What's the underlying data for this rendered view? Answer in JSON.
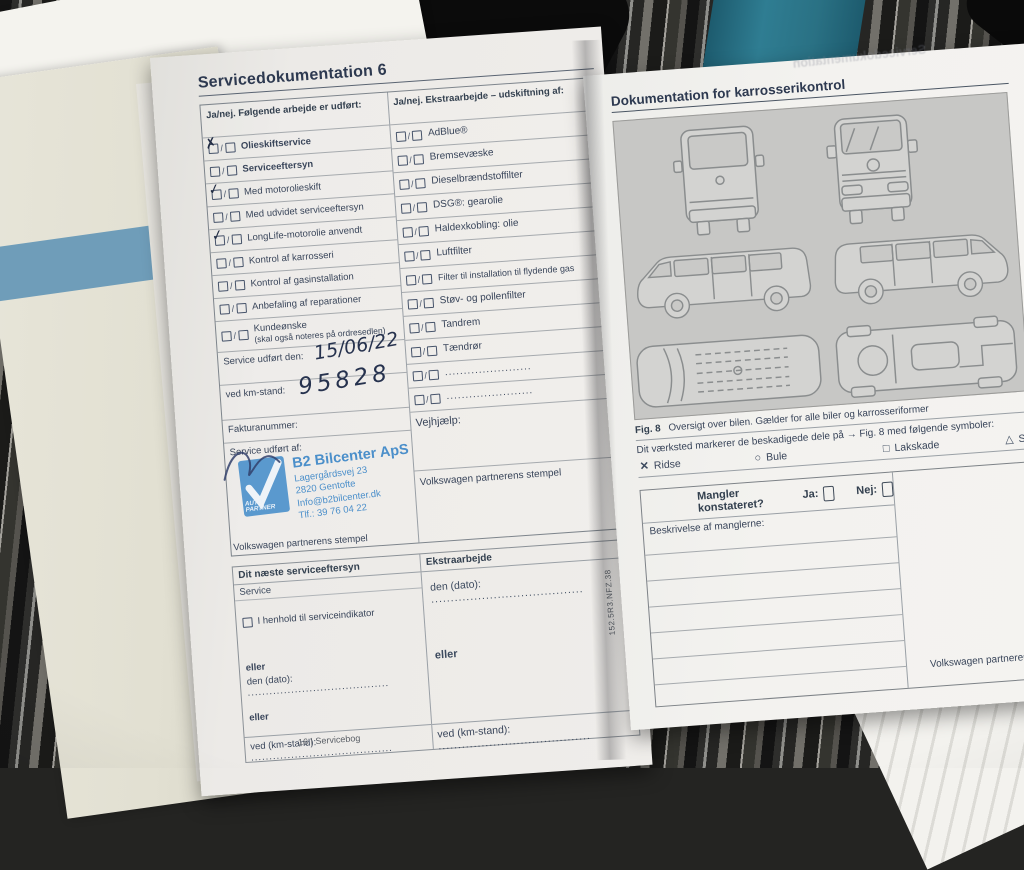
{
  "glyphs": {
    "slash": "/"
  },
  "photo": {
    "bleed_text": "Servicedokumentation"
  },
  "underlay": {
    "fragments": [
      "Fig. 1",
      "ver. la",
      "Nyvo",
      "a) Alt e"
    ]
  },
  "left_page": {
    "title": "Servicedokumentation 6",
    "col1_header": "Ja/nej. Følgende arbejde er udført:",
    "col2_header": "Ja/nej. Ekstraarbejde – udskiftning af:",
    "work_items": [
      {
        "label": "Olieskiftservice",
        "mark": "✗"
      },
      {
        "label": "Serviceeftersyn",
        "mark": ""
      },
      {
        "label": "Med motorolieskift",
        "mark": "✓"
      },
      {
        "label": "Med udvidet serviceeftersyn",
        "mark": ""
      },
      {
        "label": "LongLife-motorolie anvendt",
        "mark": "✓"
      },
      {
        "label": "Kontrol af karrosseri",
        "mark": ""
      },
      {
        "label": "Kontrol af gasinstallation",
        "mark": ""
      },
      {
        "label": "Anbefaling af reparationer",
        "mark": ""
      },
      {
        "label": "Kundeønske",
        "sublabel": "(skal også noteres på ordresedlen)",
        "mark": ""
      }
    ],
    "extra_items": [
      {
        "label": "AdBlue®"
      },
      {
        "label": "Bremsevæske"
      },
      {
        "label": "Dieselbrændstoffilter"
      },
      {
        "label": "DSG®: gearolie"
      },
      {
        "label": "Haldexkobling: olie"
      },
      {
        "label": "Luftfilter"
      },
      {
        "label": "Filter til installation til flydende gas"
      },
      {
        "label": "Støv- og pollenfilter"
      },
      {
        "label": "Tandrem"
      },
      {
        "label": "Tændrør"
      },
      {
        "label": "......................."
      },
      {
        "label": "......................."
      }
    ],
    "service_date_label": "Service udført den:",
    "service_date_value": "15/06/22",
    "km_label": "ved km-stand:",
    "km_value": "95828",
    "invoice_label": "Fakturanummer:",
    "performed_by_label": "Service udført af:",
    "roadside_label": "Vejhjælp:",
    "stamp_caption": "Volkswagen partnerens stempel",
    "stamp": {
      "logo_line1": "AUTO-",
      "logo_line2": "PARTNER",
      "name": "B2 Bilcenter ApS",
      "address1": "Lagergårdsvej 23",
      "address2": "2820 Gentofte",
      "email": "Info@b2bilcenter.dk",
      "phone": "Tlf.: 39 76 04 22"
    },
    "next_service": {
      "header_left": "Dit næste serviceeftersyn",
      "header_right": "Ekstraarbejde",
      "service_label": "Service",
      "indicator_option": "I henhold til serviceindikator",
      "or_label": "eller",
      "date_label": "den (dato):",
      "km_label": "ved (km-stand):",
      "dots": "......................................."
    },
    "footer": "16  |  Servicebog"
  },
  "right_page": {
    "title": "Dokumentation for karrosserikontrol",
    "fig_label": "Fig. 8",
    "fig_caption": "Oversigt over bilen. Gælder for alle biler og karrosseriformer",
    "symbols_intro": "Dit værksted markerer de beskadigede dele på → Fig. 8 med følgende symboler:",
    "symbols": [
      {
        "glyph": "✕",
        "label": "Ridse"
      },
      {
        "glyph": "○",
        "label": "Bule"
      },
      {
        "glyph": "□",
        "label": "Lakskade"
      },
      {
        "glyph": "△",
        "label": "Stenslag"
      }
    ],
    "defects_question": "Mangler konstateret?",
    "yes_label": "Ja:",
    "no_label": "Nej:",
    "description_label": "Beskrivelse af manglerne:",
    "stamp_caption": "Volkswagen partnerens stempel",
    "brand_footer": "Volkswagen",
    "side_code": "152.5R3.NFZ.38"
  }
}
